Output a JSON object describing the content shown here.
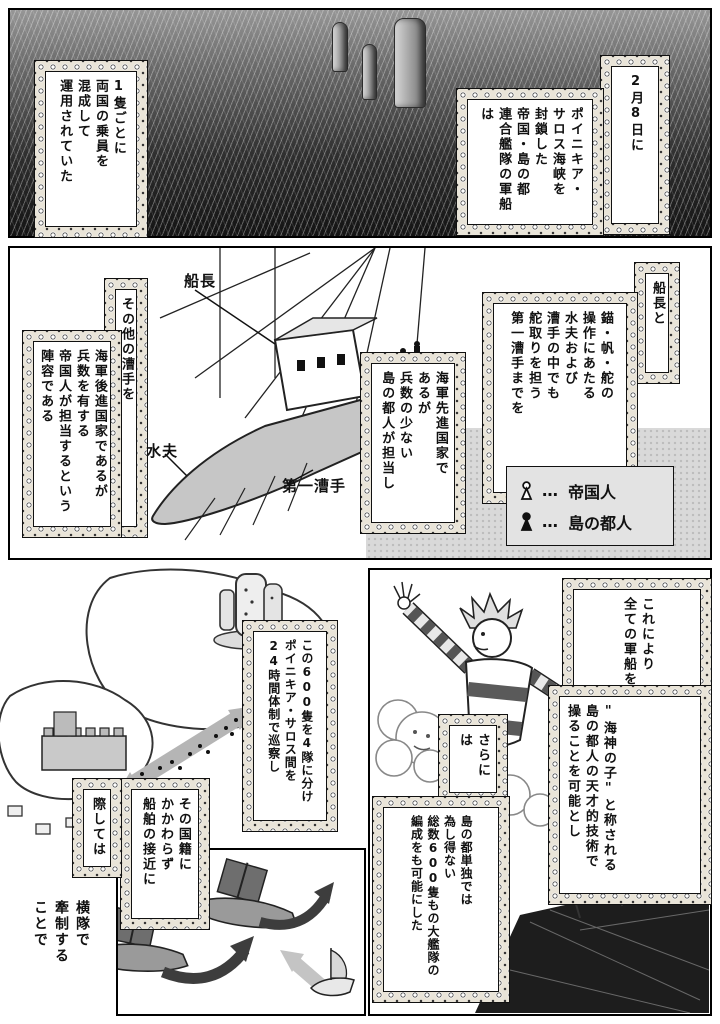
{
  "colors": {
    "ink": "#111111",
    "paper": "#ffffff",
    "tone": "#d8d8d8"
  },
  "panel_top": {
    "caption_right": {
      "head": "2月8日に",
      "body": "ポイニキア・\nサロス海峡を\n封鎖した\n帝国・島の都\n連合艦隊の軍船は",
      "furigana": [
        "がつ",
        "ようか",
        "かいきょう",
        "ふうさ",
        "ていこく",
        "リゾラーニ",
        "れんごうかんたい",
        "ぐんせん"
      ]
    },
    "caption_left": {
      "body": "1隻ごとに\n両国の乗員を\n混成して\n運用されていた",
      "furigana": [
        "せき",
        "りょうこく",
        "じょういん",
        "こんせい",
        "うんよう"
      ]
    }
  },
  "panel_middle": {
    "caption_right": {
      "head": "船長と",
      "body": "錨・帆・舵の\n操作にあたる\n水夫および\n漕手の中でも\n舵取りを担う\n第一漕手までを",
      "furigana": [
        "せんちょう",
        "いかり",
        "ほ",
        "かじ",
        "そうさ",
        "すいふ",
        "そうしゅ",
        "なか",
        "かじと",
        "にな",
        "だいいちそうしゅ"
      ]
    },
    "caption_center": {
      "body": "海軍先進国家で\nあるが\n兵数の少ない\n島の都人が担当し",
      "furigana": [
        "かいぐんせんしんこっか",
        "へいすう",
        "すく",
        "リゾラーニじん",
        "たんとう"
      ]
    },
    "caption_left": {
      "head": "その他の漕手を",
      "body": "海軍後進国家であるが\n兵数を有する\n帝国人が担当するという\n陣容である",
      "furigana": [
        "ほか",
        "そうしゅ",
        "かいぐんこうしんこっか",
        "へいすう",
        "ゆう",
        "ていこくじん",
        "たんとう",
        "じんよう"
      ]
    },
    "labels": {
      "captain": "船長",
      "sailor": "水夫",
      "first_rower": "第一漕手"
    },
    "legend": {
      "imperial": {
        "dots": "…",
        "label": "帝国人"
      },
      "islander": {
        "dots": "…",
        "label": "島の都人"
      }
    }
  },
  "panel_bottom_left": {
    "caption_patrol": {
      "body": "この600隻を4隊に分け\nポイニキア・サロス間を\n24時間体制で巡察し",
      "furigana": [
        "せき",
        "たい",
        "わ",
        "かん",
        "じかんたいせい",
        "じゅんさつ"
      ]
    },
    "caption_approach": {
      "main": "その国籍に\nかかわらず\n船舶の接近に",
      "ext": "際しては",
      "furigana": [
        "こくせき",
        "せんぱく",
        "せっきん",
        "さい"
      ]
    },
    "caption_formation": {
      "body": "横隊で\n牽制する\nことで",
      "furigana": [
        "おうたい",
        "けんせい"
      ]
    }
  },
  "panel_bottom_right": {
    "caption_enable": {
      "head": "これにより\n全ての軍船を",
      "body": "\"海神の子\"と称される\n島の都人の天才的技術で\n操ることを可能とし",
      "furigana": [
        "すべ",
        "ぐんせん",
        "かいしん",
        "こ",
        "しょう",
        "リゾラーニじん",
        "てんさいてき",
        "ぎじゅつ",
        "あやつ",
        "かのう"
      ]
    },
    "caption_fleet": {
      "head": "さらには",
      "body": "島の都単独では\n為し得ない\n総数600隻もの大艦隊の\n編成をも可能にした",
      "furigana": [
        "リゾラーニたんどく",
        "な",
        "え",
        "そうすう",
        "せき",
        "だいかんたい",
        "へんせい",
        "かのう"
      ]
    }
  }
}
